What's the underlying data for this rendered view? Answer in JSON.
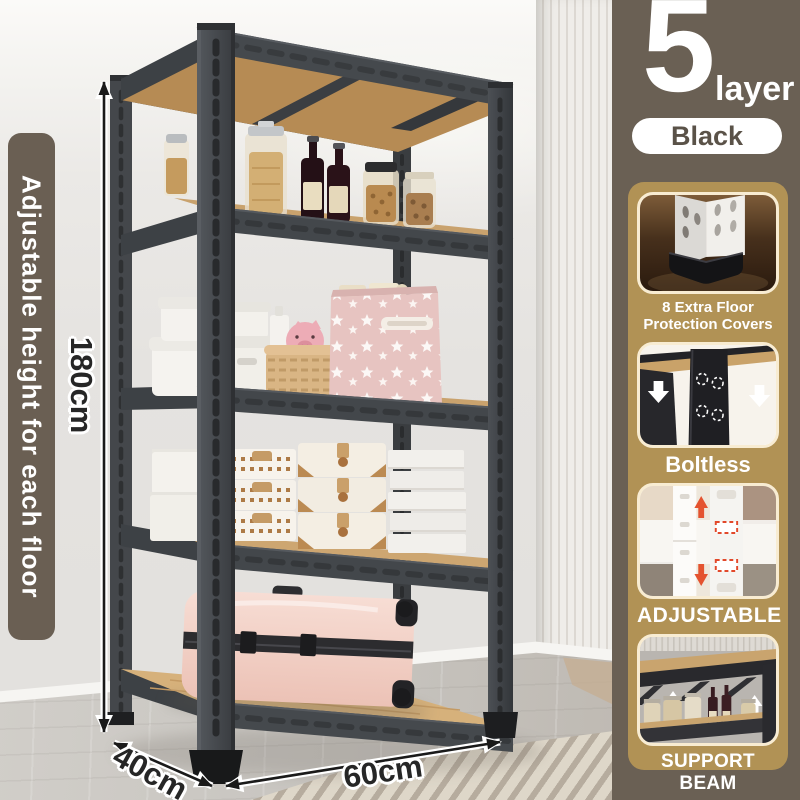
{
  "product_badge": {
    "number": "5",
    "unit": "layer",
    "variant": "Black"
  },
  "side_banner": {
    "text": "Adjustable height for each floor"
  },
  "dimensions": {
    "height": "180cm",
    "depth": "40cm",
    "width": "60cm"
  },
  "feature_panel": {
    "cards": [
      {
        "id": "floor-protection",
        "lines": [
          "8 Extra Floor",
          "Protection Covers"
        ]
      },
      {
        "id": "boltless",
        "lines": [
          "Boltless"
        ]
      },
      {
        "id": "adjustable",
        "lines": [
          "ADJUSTABLE"
        ]
      },
      {
        "id": "support-beam",
        "lines": [
          "SUPPORT BEAM"
        ]
      }
    ]
  },
  "colors": {
    "banner_brown": "#6a5f53",
    "column_brown": "#6a6054",
    "panel_tan": "#b19255",
    "card_border_cream": "#f8ecd2",
    "pill_text_brown": "#5a5248",
    "shelf_charcoal": "#43474b",
    "shelf_wood": "#c9a26d",
    "suitcase_pink": "#f2d2c8",
    "accent_red": "#e2482a"
  }
}
